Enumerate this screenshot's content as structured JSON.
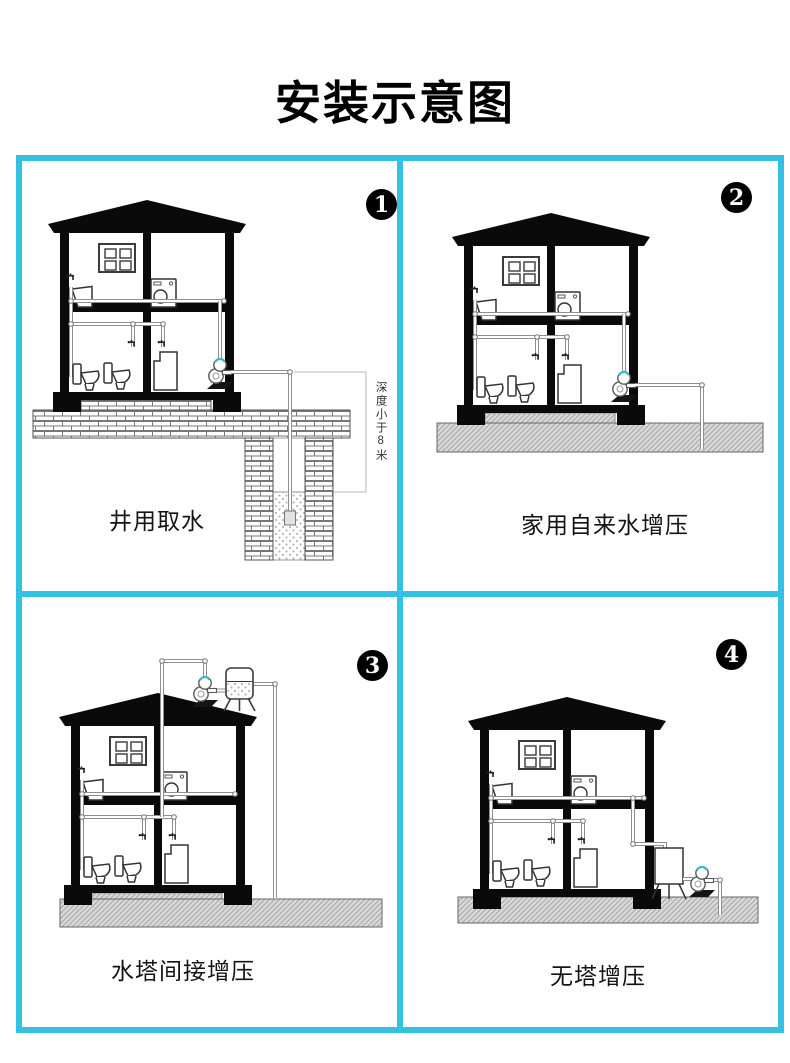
{
  "title": "安装示意图",
  "colors": {
    "accent": "#35c1e2",
    "pump-accent": "#3db8cb"
  },
  "panels": [
    {
      "badge": "1",
      "caption": "井用取水",
      "depth_note": "深度小于8米"
    },
    {
      "badge": "2",
      "caption": "家用自来水增压"
    },
    {
      "badge": "3",
      "caption": "水塔间接增压"
    },
    {
      "badge": "4",
      "caption": "无塔增压"
    }
  ]
}
